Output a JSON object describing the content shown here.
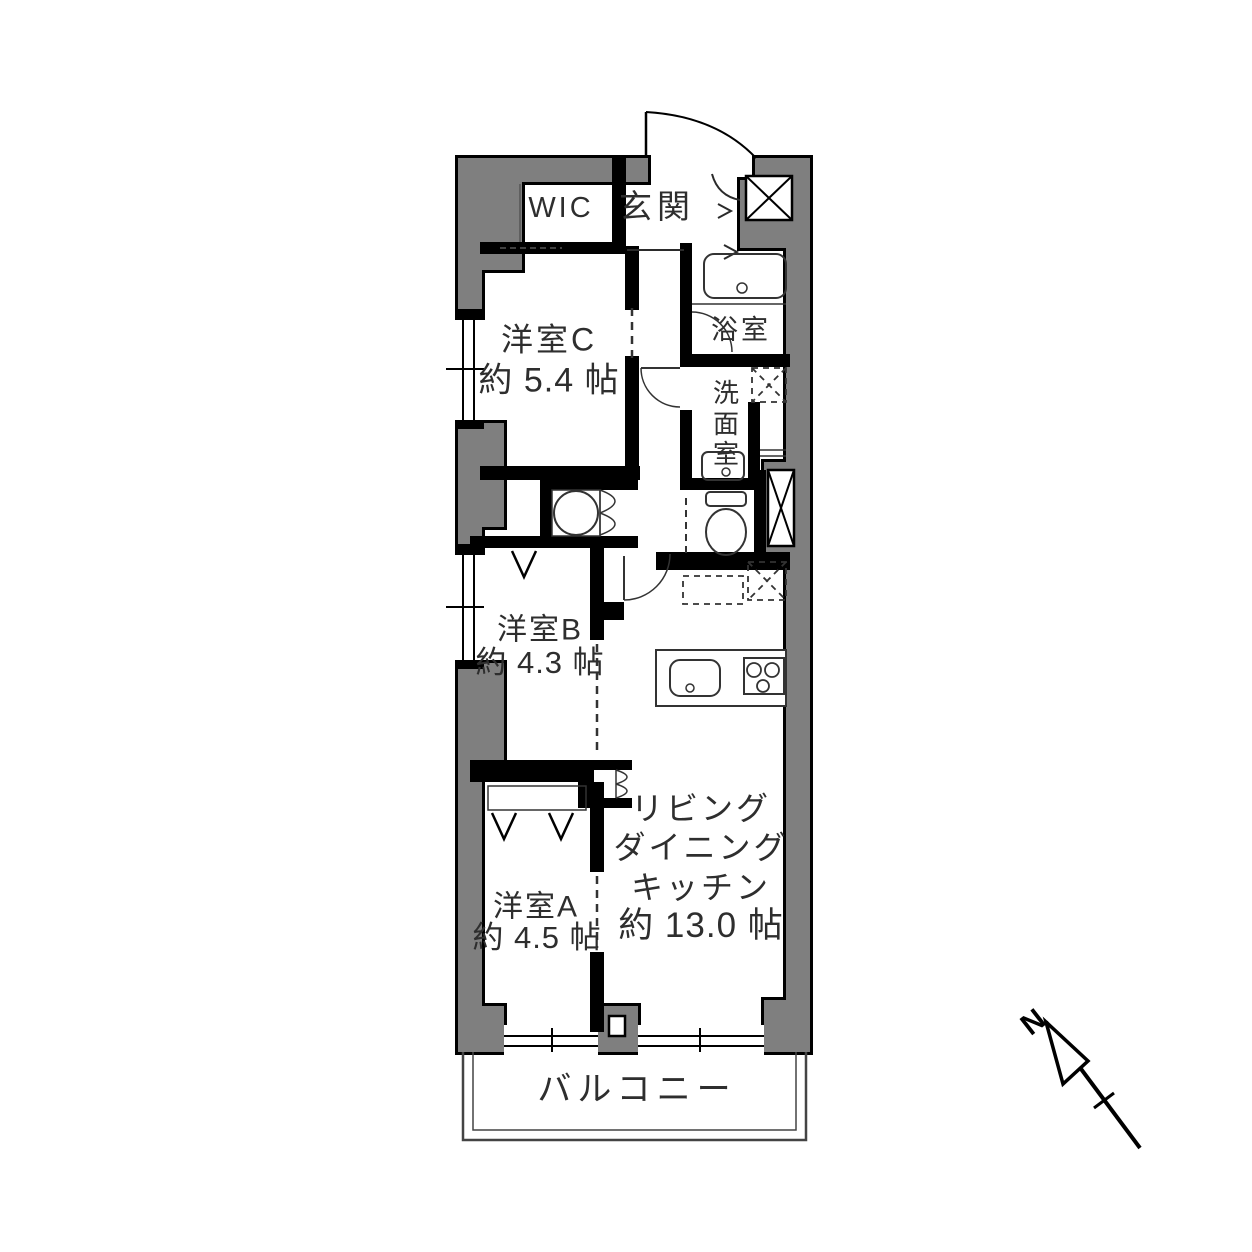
{
  "plan": {
    "wic": {
      "label": "WIC"
    },
    "genkan": {
      "label": "玄関"
    },
    "room_c": {
      "name": "洋室C",
      "size": "約 5.4 帖"
    },
    "bath": {
      "label": "浴室"
    },
    "washroom": {
      "label": "洗\n面\n室"
    },
    "room_b": {
      "name": "洋室B",
      "size": "約 4.3 帖"
    },
    "room_a": {
      "name": "洋室A",
      "size": "約 4.5 帖"
    },
    "ldk": {
      "lines": [
        "リビング",
        "ダイニング",
        "キッチン",
        "約 13.0 帖"
      ]
    },
    "balcony": {
      "label": "バルコニー"
    },
    "compass": {
      "north_label": "N"
    }
  },
  "colors": {
    "wall_fill": "#7f7f7f",
    "line": "#000000",
    "text": "#2e2e2e",
    "background": "#ffffff"
  }
}
